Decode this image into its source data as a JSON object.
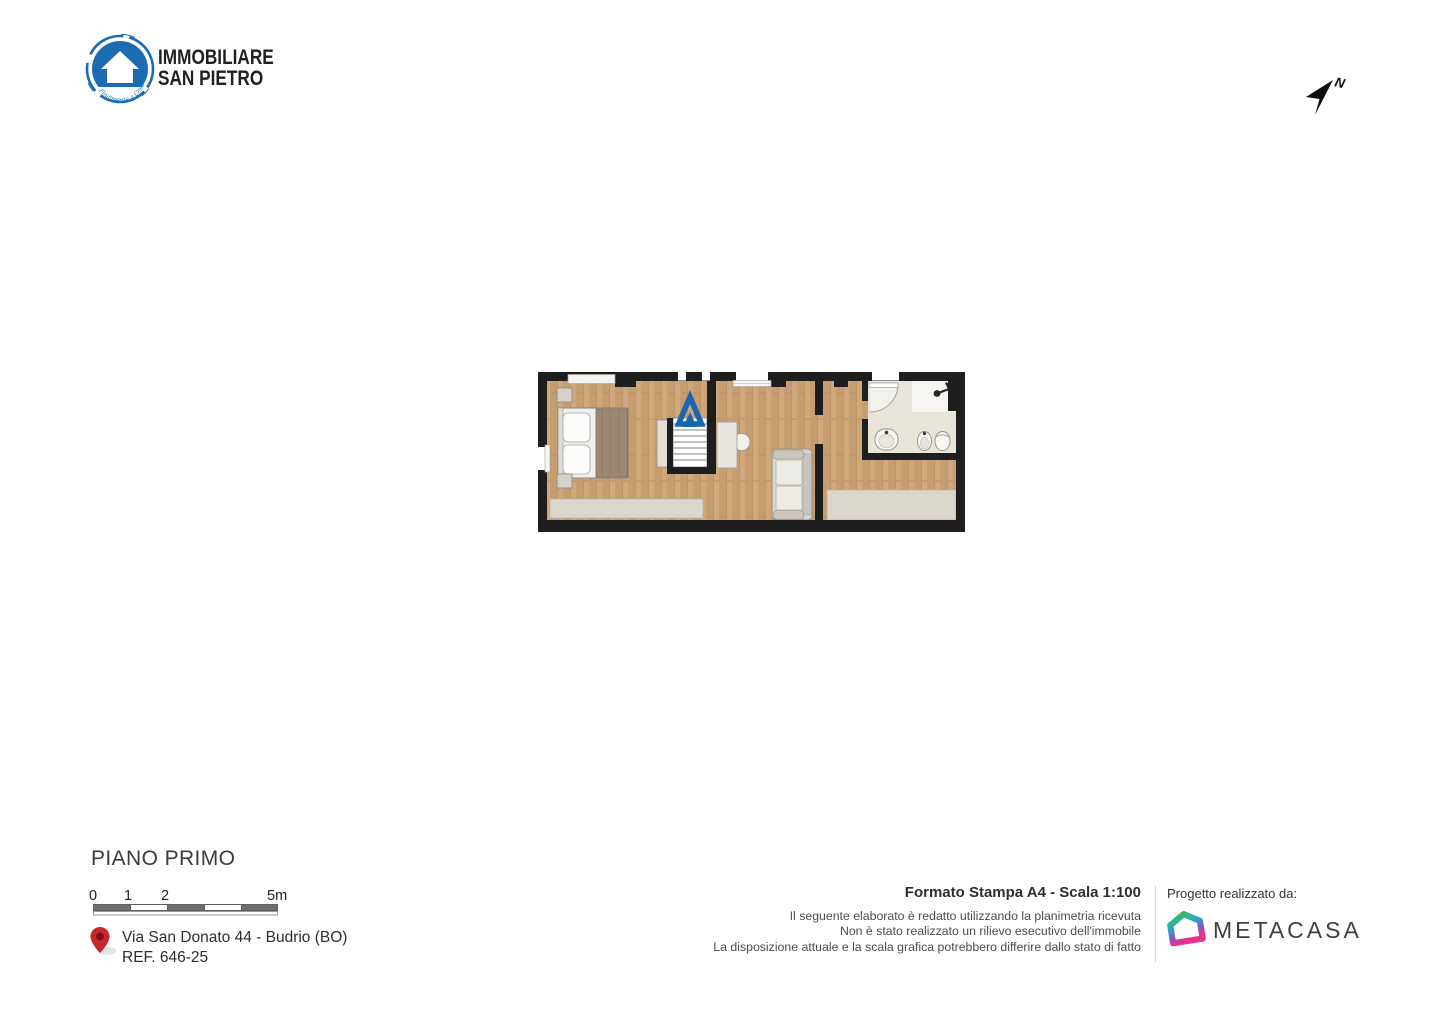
{
  "header": {
    "logo": {
      "line1": "IMMOBILIARE",
      "line2": "SAN PIETRO",
      "tagline": "Finalmente a Casa",
      "brand_color": "#1b6cb0"
    },
    "compass": {
      "label": "N"
    }
  },
  "floor_plan": {
    "colors": {
      "wall": "#1e1e1e",
      "wood": "#cfa77a",
      "terrace": "#dcd7cd",
      "bath_tile": "#e9e4da",
      "stairs_arrow_blue": "#1a66ad"
    }
  },
  "footer": {
    "title": "PIANO PRIMO",
    "scale_bar": {
      "labels": [
        "0",
        "1",
        "2",
        "5m"
      ]
    },
    "address_line1": "Via San Donato 44 - Budrio (BO)",
    "address_line2": "REF. 646-25",
    "pin_color": "#c9252c",
    "print_info": "Formato Stampa A4 - Scala 1:100",
    "disclaimer": [
      "Il seguente elaborato è redatto utilizzando la planimetria ricevuta",
      "Non è stato realizzato un rilievo esecutivo dell'immobile",
      "La disposizione attuale e la scala grafica potrebbero differire dallo stato di fatto"
    ],
    "credit_label": "Progetto realizzato da:",
    "credit_brand": "METACASA",
    "metacasa_gradient": [
      "#43b649",
      "#2cb5a3",
      "#3e8fd8",
      "#8a52c5",
      "#e8308f"
    ]
  }
}
